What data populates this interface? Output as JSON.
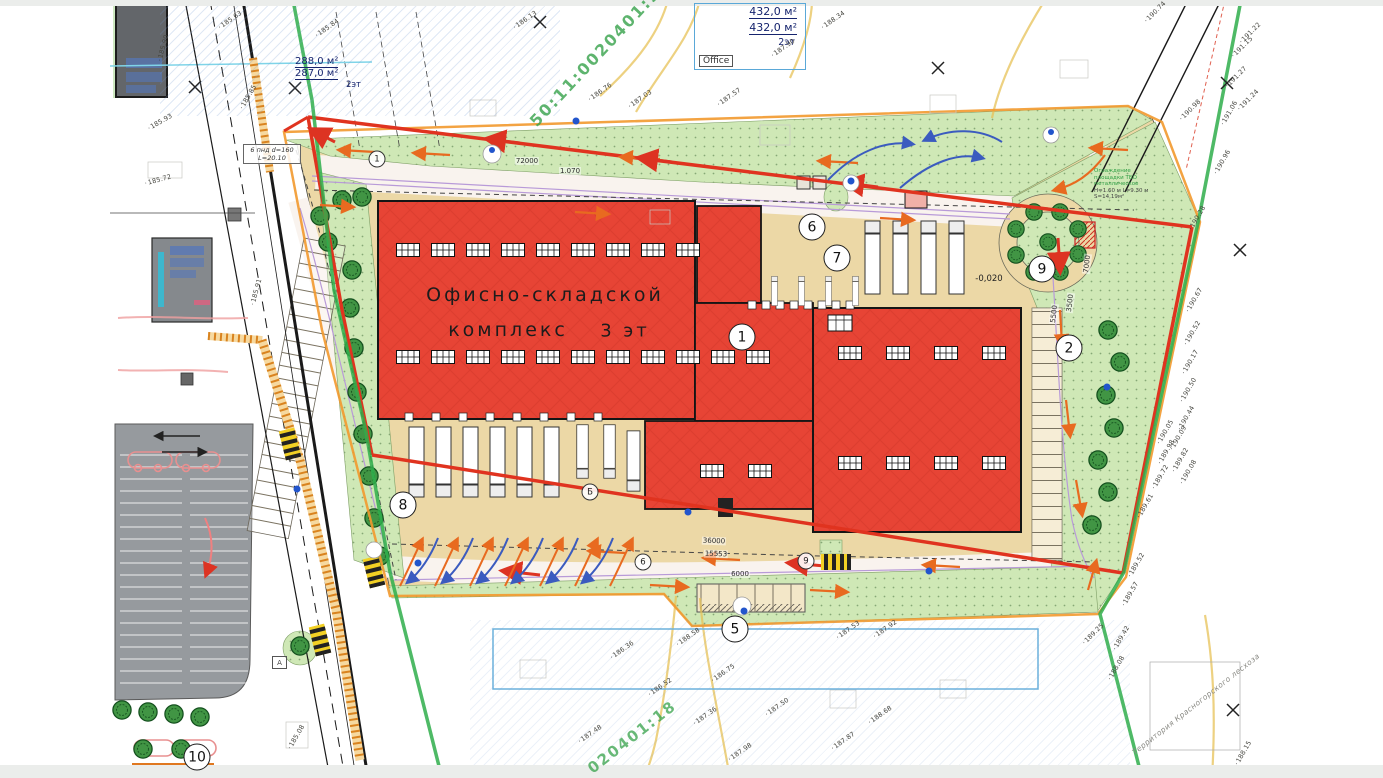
{
  "plan": {
    "building_label": {
      "line1": "Офисно-складской",
      "line2": "комплекс",
      "line3": "3 эт"
    },
    "cadastral": {
      "upper": "50:11:0020401:9",
      "lower": "020401:18"
    },
    "info_box_top": {
      "line1": "432,0 м²",
      "line2": "432,0 м²",
      "line3": "2эт",
      "office": "Office"
    },
    "info_box_left": {
      "line1": "288,0 м²",
      "line2": "287,0 м²",
      "line3": "2эт"
    },
    "pipe_note": {
      "line1": "6 пнд d=160",
      "line2": "L=20.10"
    },
    "fence_note": {
      "l1": "Ограждение",
      "l2": "площадки ТБО",
      "l3": "металлическое",
      "l4": "H=1.60 м L=9.30 м",
      "l5": "S=14,19м²"
    },
    "forest_label": "Территория Красногорского лесхоза",
    "level_label": "-0,020",
    "area_label_a": "А",
    "markers": [
      {
        "label": "1",
        "x": 742,
        "y": 337
      },
      {
        "label": "2",
        "x": 1069,
        "y": 348
      },
      {
        "label": "5",
        "x": 735,
        "y": 629
      },
      {
        "label": "6",
        "x": 812,
        "y": 227
      },
      {
        "label": "7",
        "x": 837,
        "y": 258
      },
      {
        "label": "8",
        "x": 403,
        "y": 505
      },
      {
        "label": "9",
        "x": 1042,
        "y": 269
      },
      {
        "label": "10",
        "x": 197,
        "y": 757
      }
    ],
    "axis_bubbles": [
      {
        "label": "1",
        "x": 377,
        "y": 159
      },
      {
        "label": "Б",
        "x": 590,
        "y": 492
      },
      {
        "label": "6",
        "x": 643,
        "y": 562
      },
      {
        "label": "9",
        "x": 806,
        "y": 561
      }
    ],
    "dimensions": [
      {
        "text": "72000",
        "x": 527,
        "y": 161,
        "rot": 0
      },
      {
        "text": "1.070",
        "x": 570,
        "y": 171,
        "rot": 0
      },
      {
        "text": "36000",
        "x": 714,
        "y": 541,
        "rot": 2
      },
      {
        "text": "15553",
        "x": 716,
        "y": 554,
        "rot": 2
      },
      {
        "text": "6000",
        "x": 740,
        "y": 574,
        "rot": 0
      },
      {
        "text": "7000",
        "x": 1087,
        "y": 264,
        "rot": -83
      },
      {
        "text": "5500",
        "x": 1054,
        "y": 314,
        "rot": -83
      },
      {
        "text": "3500",
        "x": 1070,
        "y": 303,
        "rot": -83
      }
    ],
    "elevations": [
      {
        "text": "185.90",
        "x": 163,
        "y": 48,
        "rot": -75
      },
      {
        "text": "185.93",
        "x": 160,
        "y": 122,
        "rot": -30
      },
      {
        "text": "185.72",
        "x": 158,
        "y": 180,
        "rot": -15
      },
      {
        "text": "185.85",
        "x": 248,
        "y": 97,
        "rot": -60
      },
      {
        "text": "185.91",
        "x": 256,
        "y": 292,
        "rot": -75
      },
      {
        "text": "185.63",
        "x": 230,
        "y": 20,
        "rot": -35
      },
      {
        "text": "185.84",
        "x": 327,
        "y": 28,
        "rot": -35
      },
      {
        "text": "186.13",
        "x": 525,
        "y": 20,
        "rot": -35
      },
      {
        "text": "186.76",
        "x": 600,
        "y": 92,
        "rot": -35
      },
      {
        "text": "187.03",
        "x": 640,
        "y": 99,
        "rot": -35
      },
      {
        "text": "187.57",
        "x": 729,
        "y": 97,
        "rot": -35
      },
      {
        "text": "187.90",
        "x": 783,
        "y": 48,
        "rot": -35
      },
      {
        "text": "188.34",
        "x": 833,
        "y": 20,
        "rot": -35
      },
      {
        "text": "185.08",
        "x": 296,
        "y": 737,
        "rot": -60
      },
      {
        "text": "186.36",
        "x": 622,
        "y": 650,
        "rot": -35
      },
      {
        "text": "186.52",
        "x": 660,
        "y": 687,
        "rot": -35
      },
      {
        "text": "186.75",
        "x": 723,
        "y": 673,
        "rot": -35
      },
      {
        "text": "187.36",
        "x": 705,
        "y": 716,
        "rot": -35
      },
      {
        "text": "187.50",
        "x": 777,
        "y": 707,
        "rot": -35
      },
      {
        "text": "187.48",
        "x": 590,
        "y": 734,
        "rot": -35
      },
      {
        "text": "187.98",
        "x": 740,
        "y": 752,
        "rot": -35
      },
      {
        "text": "187.87",
        "x": 843,
        "y": 741,
        "rot": -35
      },
      {
        "text": "188.68",
        "x": 880,
        "y": 715,
        "rot": -35
      },
      {
        "text": "188.58",
        "x": 688,
        "y": 637,
        "rot": -35
      },
      {
        "text": "187.53",
        "x": 848,
        "y": 630,
        "rot": -35
      },
      {
        "text": "187.92",
        "x": 885,
        "y": 629,
        "rot": -35
      },
      {
        "text": "188.15",
        "x": 1243,
        "y": 753,
        "rot": -60
      },
      {
        "text": "188.08",
        "x": 1116,
        "y": 668,
        "rot": -60
      },
      {
        "text": "189.25",
        "x": 1093,
        "y": 634,
        "rot": -45
      },
      {
        "text": "189.42",
        "x": 1121,
        "y": 638,
        "rot": -60
      },
      {
        "text": "189.52",
        "x": 1136,
        "y": 565,
        "rot": -60
      },
      {
        "text": "189.57",
        "x": 1130,
        "y": 594,
        "rot": -60
      },
      {
        "text": "189.61",
        "x": 1145,
        "y": 506,
        "rot": -60
      },
      {
        "text": "189.72",
        "x": 1160,
        "y": 477,
        "rot": -60
      },
      {
        "text": "189.98",
        "x": 1166,
        "y": 452,
        "rot": -60
      },
      {
        "text": "189.82",
        "x": 1180,
        "y": 460,
        "rot": -60
      },
      {
        "text": "190.08",
        "x": 1188,
        "y": 472,
        "rot": -60
      },
      {
        "text": "190.05",
        "x": 1165,
        "y": 432,
        "rot": -60
      },
      {
        "text": "190.09",
        "x": 1178,
        "y": 438,
        "rot": -60
      },
      {
        "text": "190.28",
        "x": 1197,
        "y": 218,
        "rot": -60
      },
      {
        "text": "190.67",
        "x": 1194,
        "y": 300,
        "rot": -60
      },
      {
        "text": "190.52",
        "x": 1192,
        "y": 333,
        "rot": -60
      },
      {
        "text": "190.17",
        "x": 1190,
        "y": 362,
        "rot": -60
      },
      {
        "text": "190.50",
        "x": 1188,
        "y": 390,
        "rot": -60
      },
      {
        "text": "190.44",
        "x": 1186,
        "y": 418,
        "rot": -60
      },
      {
        "text": "190.98",
        "x": 1190,
        "y": 110,
        "rot": -45
      },
      {
        "text": "190.96",
        "x": 1222,
        "y": 162,
        "rot": -60
      },
      {
        "text": "191.06",
        "x": 1229,
        "y": 113,
        "rot": -60
      },
      {
        "text": "191.22",
        "x": 1250,
        "y": 33,
        "rot": -45
      },
      {
        "text": "191.15",
        "x": 1242,
        "y": 47,
        "rot": -45
      },
      {
        "text": "191.27",
        "x": 1236,
        "y": 77,
        "rot": -45
      },
      {
        "text": "191.24",
        "x": 1248,
        "y": 100,
        "rot": -45
      },
      {
        "text": "190.74",
        "x": 1155,
        "y": 12,
        "rot": -45
      }
    ],
    "colors": {
      "building_red": "#e74435",
      "green_area": "#cfe8b6",
      "pavement_tan": "#ecd8a6",
      "boundary_red": "#e0331f",
      "boundary_orange": "#f2992e",
      "cadastral_green": "#2fae4b",
      "note_blue": "#5aa8d8",
      "handwriting_blue": "#16246e"
    }
  }
}
